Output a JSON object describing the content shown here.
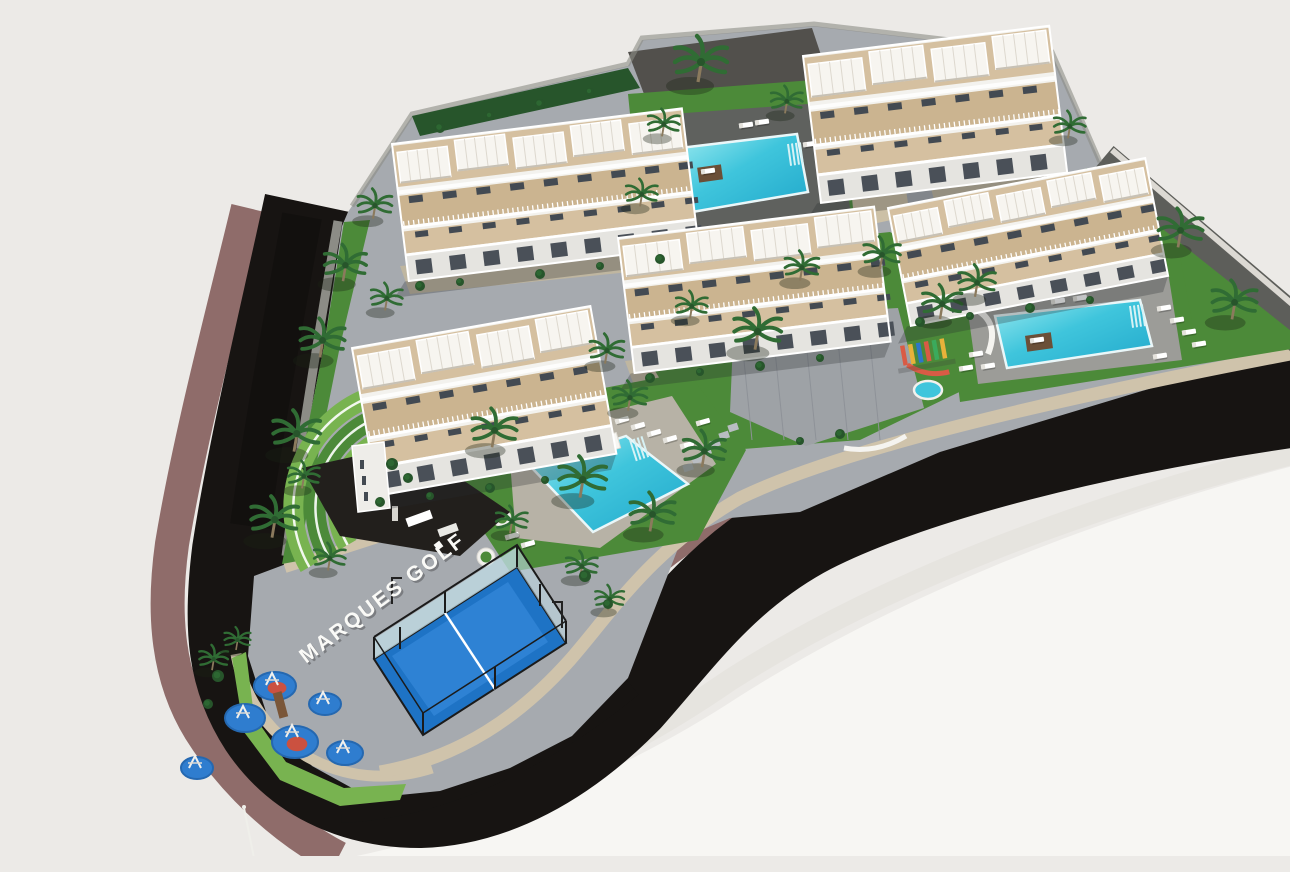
{
  "image": {
    "kind": "3d-architectural-aerial-render",
    "project_name": "MARQUES GOLF",
    "signage": {
      "pavement_text": "MARQUES GOLF"
    },
    "features": {
      "apartment_buildings": 5,
      "swimming_pools": 3,
      "padel_courts": 1,
      "children_playgrounds": 2,
      "visible_amenities": [
        "communal swimming pools",
        "padel court",
        "children playground",
        "outdoor gym circles",
        "roof terraces with pergolas",
        "palm tree gardens",
        "perimeter road"
      ]
    },
    "colors": {
      "background": "#ECEAE7",
      "empty_land": "#F7F6F3",
      "land_edge": "#E2DED8",
      "road": "#171412",
      "sidewalk": "#8F6C6A",
      "wall_beige": "#CFC3AB",
      "wall_gray": "#8C8C86",
      "wall_dark": "#5D5E5A",
      "paving": "#A6AAAF",
      "paving_dark": "#52504C",
      "plaza": "#9EA2A6",
      "plaza_line": "#8E9298",
      "stone_path": "#CCC0A6",
      "gabion": "#C2B79F",
      "lawn": "#4C8A39",
      "lawn_light": "#78B350",
      "pool_shallow": "#9BEAF0",
      "pool_deep": "#21A8CB",
      "pool_mid": "#3FC5DC",
      "pool_deck_dark": "#5F615E",
      "pool_deck_light": "#9C9C98",
      "pool_deck_beige": "#B7B2A6",
      "building_wall": "#F3F2EE",
      "terrace": "#D5C0A0",
      "terrace2": "#CBB490",
      "building_front": "#E5E4E0",
      "window": "#434A52",
      "padel_court": "#1E73C5",
      "padel_court_light": "#3487D8",
      "padel_frame": "#1B1B1B",
      "padel_glass": "#BFD9E2",
      "playground_blue": "#2F7DCF",
      "playground_blue_rim": "#2568B0",
      "playground_red": "#CB5140",
      "palm": "#306C34",
      "palm_dark": "#27552B",
      "trunk": "#8B7A5D",
      "white": "#FAFAF7",
      "daybed_wood": "#6B4F37"
    }
  }
}
